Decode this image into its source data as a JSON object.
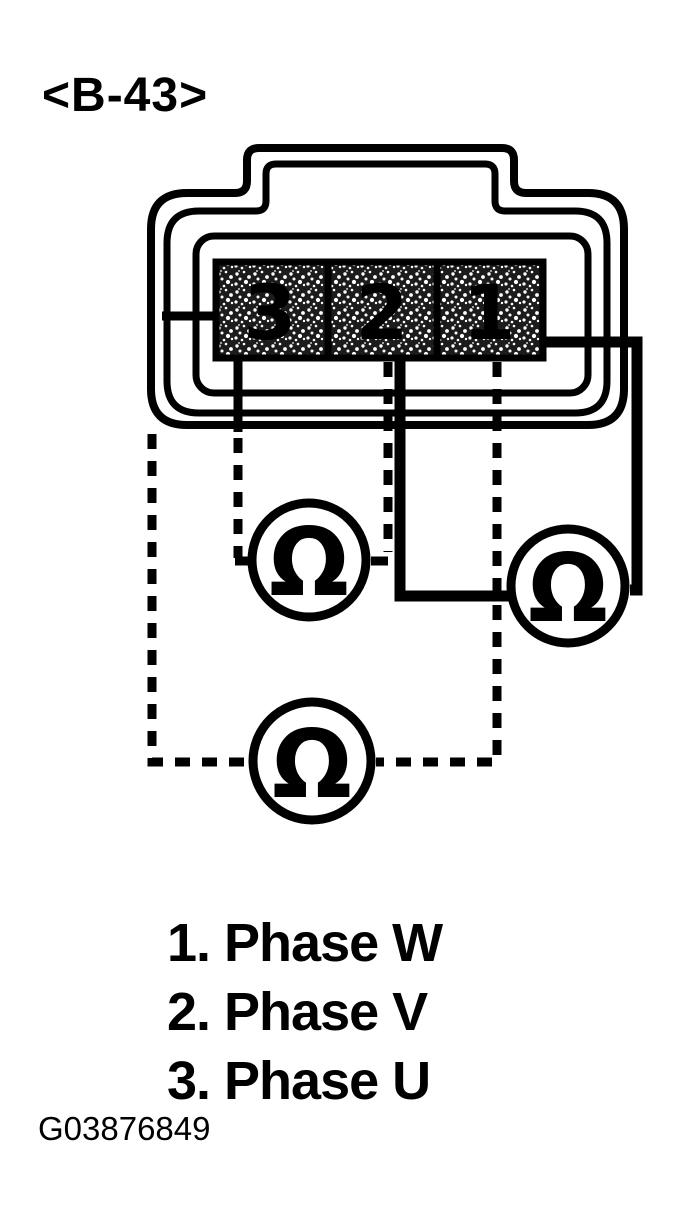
{
  "figure": {
    "title": "<B-43>",
    "figure_id": "G03876849"
  },
  "connector": {
    "terminals": {
      "left": "3",
      "middle": "2",
      "right": "1"
    }
  },
  "meters": {
    "symbol": "Ω",
    "count": 3
  },
  "legend": {
    "items": [
      {
        "text": "1. Phase W"
      },
      {
        "text": "2. Phase V"
      },
      {
        "text": "3. Phase U"
      }
    ]
  },
  "colors": {
    "ink": "#000000",
    "paper": "#ffffff"
  }
}
